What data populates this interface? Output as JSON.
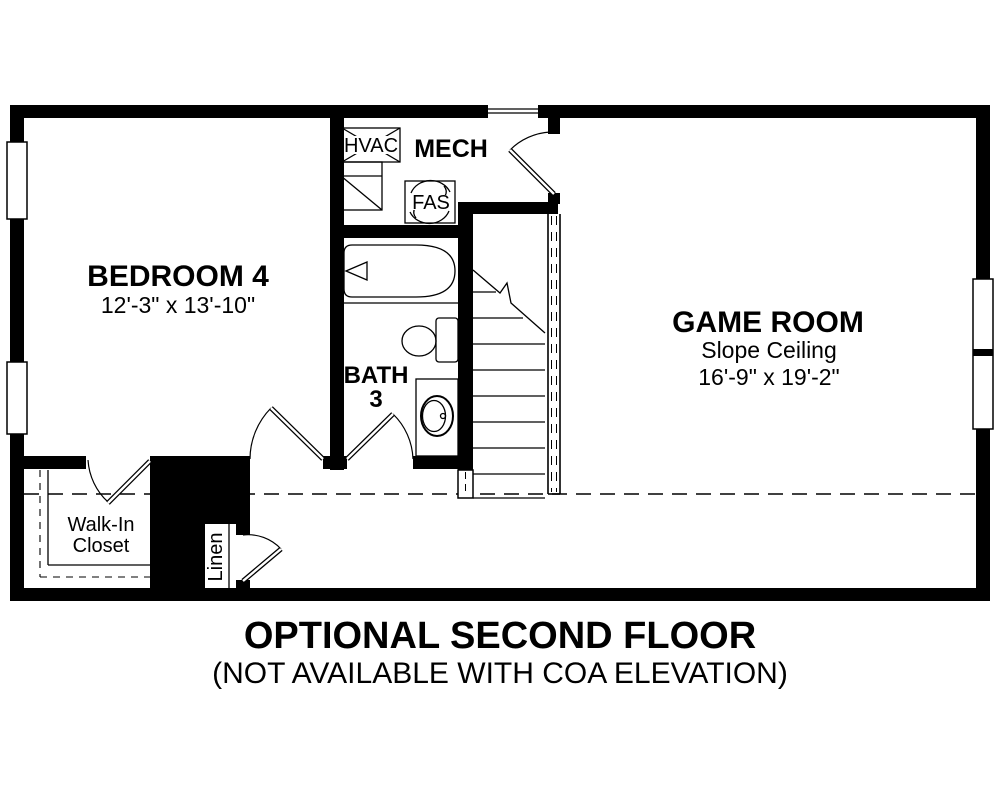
{
  "plan": {
    "rooms": {
      "bedroom4": {
        "name": "BEDROOM 4",
        "dimensions": "12'-3\" x 13'-10\""
      },
      "game_room": {
        "name": "GAME ROOM",
        "ceiling": "Slope Ceiling",
        "dimensions": "16'-9\" x 19'-2\""
      },
      "bath3": {
        "name": "BATH",
        "number": "3"
      },
      "mech": {
        "name": "MECH"
      },
      "walk_in_closet": {
        "line1": "Walk-In",
        "line2": "Closet"
      },
      "linen": {
        "name": "Linen"
      }
    },
    "equipment": {
      "hvac": "HVAC",
      "fas": "FAS"
    }
  },
  "caption": {
    "line1": "OPTIONAL SECOND FLOOR",
    "line2": "(NOT AVAILABLE WITH COA ELEVATION)"
  },
  "colors": {
    "ink": "#000000",
    "background": "#ffffff"
  }
}
